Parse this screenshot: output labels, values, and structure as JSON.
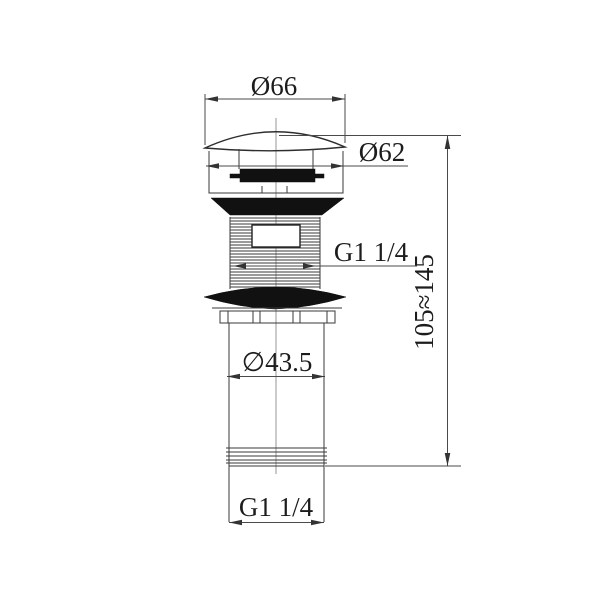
{
  "drawing": {
    "background_color": "#ffffff",
    "line_color": "#2e2e2e",
    "solid_fill_color": "#111111",
    "dimension_color": "#4a4a4a",
    "labels": {
      "cap_outer_diameter": "Ø66",
      "cap_lip_diameter": "Ø62",
      "top_thread_size": "G1 1/4",
      "installed_height_range": "105≈145",
      "tail_tube_diameter": "∅43.5",
      "bottom_thread_size": "G1 1/4"
    }
  }
}
